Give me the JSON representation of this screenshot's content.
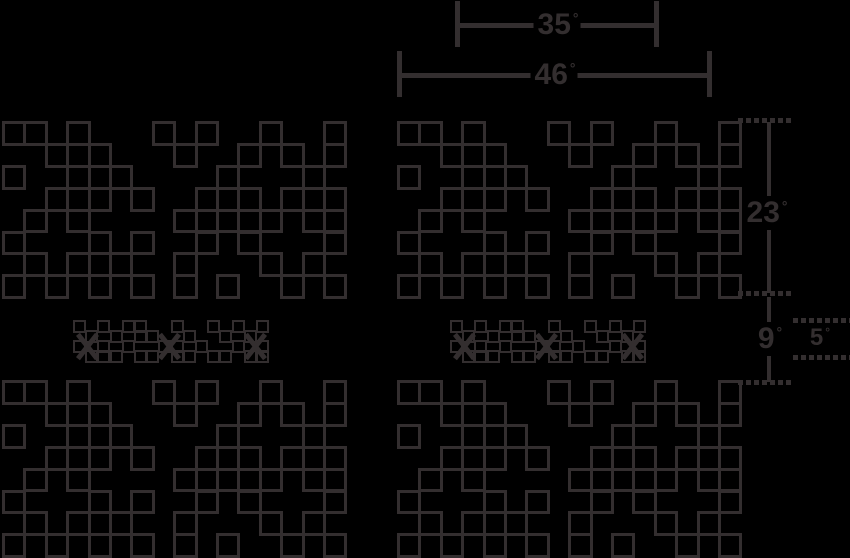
{
  "canvas": {
    "width": 850,
    "height": 558,
    "background": "#000000",
    "line_color": "#332e2f"
  },
  "dimensions": {
    "d35": {
      "value": "35",
      "unit": "°"
    },
    "d46": {
      "value": "46",
      "unit": "°"
    },
    "d23": {
      "value": "23",
      "unit": "°"
    },
    "d9": {
      "value": "9",
      "unit": "°"
    },
    "d5": {
      "value": "5",
      "unit": "°"
    }
  },
  "pattern_grid": {
    "cell_w": 21.4,
    "cell_h": 21.9,
    "stroke_px": 3,
    "rows": [
      "1101000101001001",
      "0011100010010101",
      "1001110000100010",
      "0011101001110111",
      "0101000011111011",
      "1000101001010001",
      "0101110010001010",
      "1010101010100101"
    ],
    "blocks": [
      {
        "name": "halftone-block-top-left",
        "x": 2,
        "y": 121
      },
      {
        "name": "halftone-block-top-right",
        "x": 397,
        "y": 121
      },
      {
        "name": "halftone-block-bottom-left",
        "x": 2,
        "y": 380
      },
      {
        "name": "halftone-block-bottom-right",
        "x": 397,
        "y": 380
      }
    ]
  },
  "mini_strips": {
    "cell_w": 12.2,
    "row_pitch": 10,
    "square_px": 13,
    "stroke_px": 2,
    "rows": [
      "1010110010010101",
      "0101011001001010",
      "1010100110100101",
      "0111011011011011"
    ],
    "positions": [
      {
        "name": "mini-pattern-strip-left",
        "x": 73,
        "y": 320
      },
      {
        "name": "mini-pattern-strip-right",
        "x": 450,
        "y": 320
      }
    ],
    "x_marks": [
      {
        "dx": 4,
        "dy": 13
      },
      {
        "dx": 86,
        "dy": 13
      },
      {
        "dx": 172,
        "dy": 13
      }
    ]
  }
}
